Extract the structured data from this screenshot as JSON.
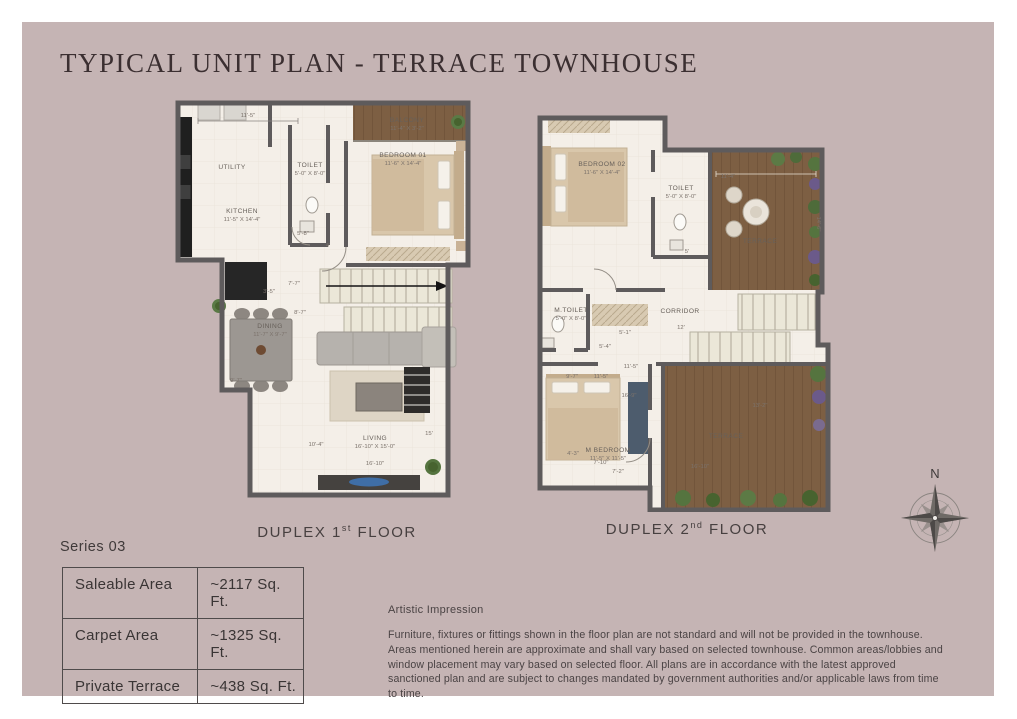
{
  "page": {
    "title": "TYPICAL UNIT PLAN - TERRACE TOWNHOUSE",
    "series_label": "Series 03"
  },
  "colors": {
    "sheet_bg": "#c5b4b4",
    "title_text": "#3b2f31",
    "wall": "#5e5b5c",
    "floor": "#f4efe8",
    "terrace_wood": "#7d5f43",
    "table_border": "#4f4b4b"
  },
  "plans": [
    {
      "name": "duplex-1st-floor",
      "caption": {
        "prefix": "DUPLEX 1",
        "sup": "st",
        "suffix": " FLOOR"
      },
      "rooms": [
        {
          "x": 62,
          "y": 74,
          "label": "UTILITY"
        },
        {
          "x": 72,
          "y": 118,
          "label": "KITCHEN",
          "dims": "11'-5\" X 14'-4\""
        },
        {
          "x": 140,
          "y": 72,
          "label": "TOILET",
          "dims": "5'-0\" X 8'-0\""
        },
        {
          "x": 233,
          "y": 62,
          "label": "BEDROOM 01",
          "dims": "11'-6\" X 14'-4\""
        },
        {
          "x": 237,
          "y": 27,
          "label": "BALCONY",
          "dims": "11'-4\" X 3'-2\""
        },
        {
          "x": 100,
          "y": 233,
          "label": "DINING",
          "dims": "11'-7\" X 9'-7\""
        },
        {
          "x": 205,
          "y": 345,
          "label": "LIVING",
          "dims": "16'-10\" X 15'-0\""
        }
      ],
      "dims": [
        {
          "x": 78,
          "y": 22,
          "t": "11'-5\""
        },
        {
          "x": 133,
          "y": 140,
          "t": "5'-8\""
        },
        {
          "x": 158,
          "y": 152,
          "t": "4'"
        },
        {
          "x": 124,
          "y": 190,
          "t": "7'-7\""
        },
        {
          "x": 99,
          "y": 198,
          "t": "3'-5\""
        },
        {
          "x": 130,
          "y": 219,
          "t": "8'-7\""
        },
        {
          "x": 66,
          "y": 287,
          "t": "9'-7\""
        },
        {
          "x": 146,
          "y": 351,
          "t": "10'-4\""
        },
        {
          "x": 205,
          "y": 370,
          "t": "16'-10\""
        },
        {
          "x": 259,
          "y": 340,
          "t": "15'"
        }
      ]
    },
    {
      "name": "duplex-2nd-floor",
      "caption": {
        "prefix": "DUPLEX 2",
        "sup": "nd",
        "suffix": " FLOOR"
      },
      "rooms": [
        {
          "x": 74,
          "y": 54,
          "label": "BEDROOM 02",
          "dims": "11'-6\" X 14'-4\""
        },
        {
          "x": 153,
          "y": 78,
          "label": "TOILET",
          "dims": "5'-0\" X 8'-0\""
        },
        {
          "x": 232,
          "y": 131,
          "label": "TERRACE"
        },
        {
          "x": 43,
          "y": 200,
          "label": "M.TOILET",
          "dims": "5'-0\" X 8'-0\""
        },
        {
          "x": 152,
          "y": 201,
          "label": "CORRIDOR"
        },
        {
          "x": 80,
          "y": 340,
          "label": "M BEDROOM",
          "dims": "11'-5\" X 11'-5\""
        },
        {
          "x": 198,
          "y": 326,
          "label": "TERRACE"
        }
      ],
      "dims": [
        {
          "x": 200,
          "y": 66,
          "t": "11'-4\""
        },
        {
          "x": 289,
          "y": 112,
          "t": "14'-6\"",
          "rot": 90
        },
        {
          "x": 159,
          "y": 141,
          "t": "5'"
        },
        {
          "x": 153,
          "y": 217,
          "t": "12'"
        },
        {
          "x": 97,
          "y": 222,
          "t": "5'-1\""
        },
        {
          "x": 77,
          "y": 236,
          "t": "5'-4\""
        },
        {
          "x": 103,
          "y": 256,
          "t": "11'-5\""
        },
        {
          "x": 44,
          "y": 266,
          "t": "9'-7\""
        },
        {
          "x": 73,
          "y": 266,
          "t": "11'-5\""
        },
        {
          "x": 101,
          "y": 285,
          "t": "16'-9\""
        },
        {
          "x": 45,
          "y": 343,
          "t": "4'-3\""
        },
        {
          "x": 73,
          "y": 352,
          "t": "7'-10\""
        },
        {
          "x": 90,
          "y": 361,
          "t": "7'-2\""
        },
        {
          "x": 232,
          "y": 295,
          "t": "13'-2\""
        },
        {
          "x": 172,
          "y": 356,
          "t": "16'-10\""
        }
      ]
    }
  ],
  "area_table": {
    "rows": [
      {
        "label": "Saleable Area",
        "value": "~2117 Sq. Ft."
      },
      {
        "label": "Carpet Area",
        "value": "~1325 Sq. Ft."
      },
      {
        "label": "Private Terrace",
        "value": "~438 Sq. Ft."
      }
    ]
  },
  "disclaimer": {
    "heading": "Artistic Impression",
    "body": "Furniture, fixtures or fittings shown in the floor plan are not standard and will not be provided in the townhouse. Areas mentioned herein are approximate and shall vary based on selected townhouse. Common areas/lobbies and window placement may vary based on selected floor. All plans are in accordance with the latest approved sanctioned plan and are subject to changes mandated by government authorities and/or applicable laws from time to time."
  },
  "compass": {
    "label": "N"
  }
}
